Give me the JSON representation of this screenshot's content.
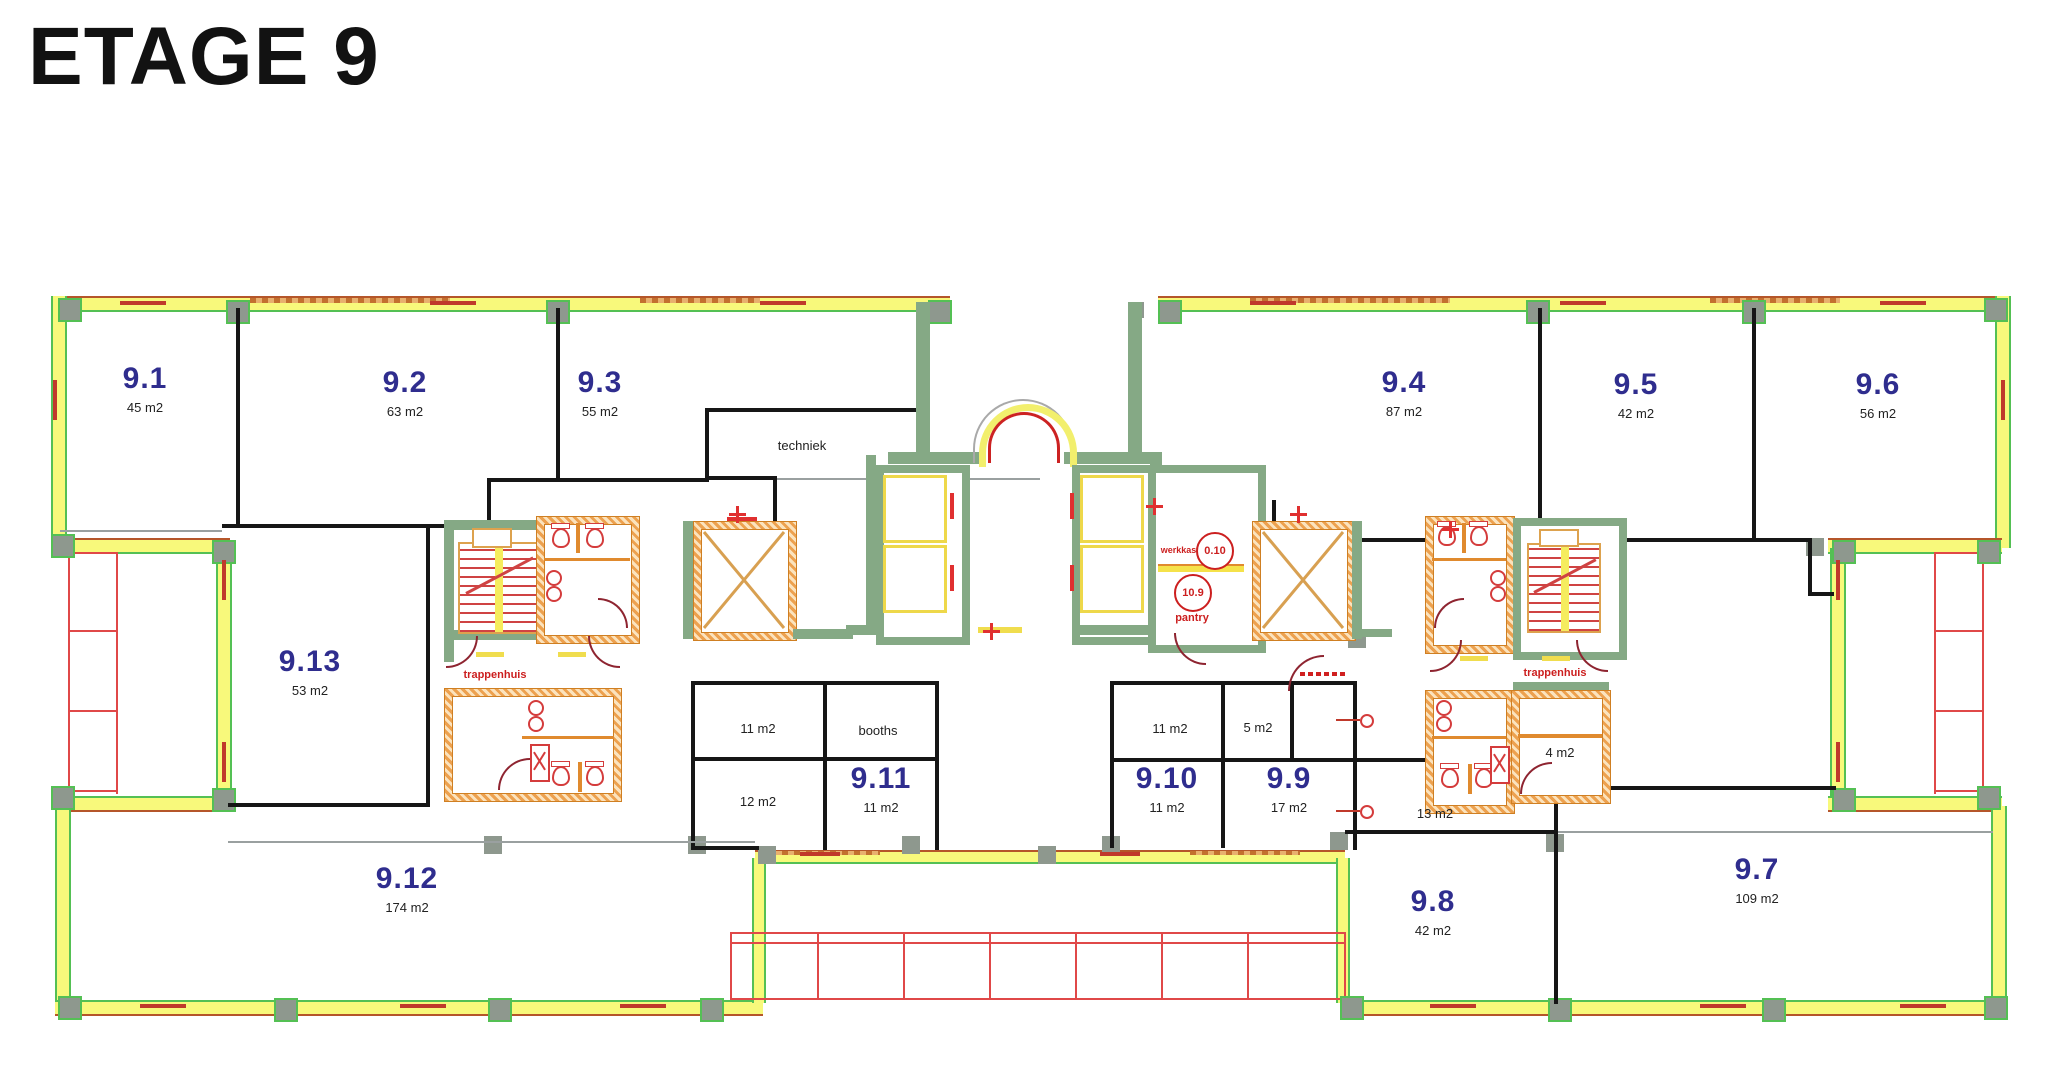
{
  "title": "ETAGE 9",
  "rooms": [
    {
      "number": "9.1",
      "area": "45 m2"
    },
    {
      "number": "9.2",
      "area": "63 m2"
    },
    {
      "number": "9.3",
      "area": "55 m2"
    },
    {
      "number": "9.4",
      "area": "87 m2"
    },
    {
      "number": "9.5",
      "area": "42 m2"
    },
    {
      "number": "9.6",
      "area": "56 m2"
    },
    {
      "number": "9.7",
      "area": "109 m2"
    },
    {
      "number": "9.8",
      "area": "42 m2"
    },
    {
      "number": "9.9",
      "area": "17 m2"
    },
    {
      "number": "9.10",
      "area": "11 m2"
    },
    {
      "number": "9.11",
      "area": "11 m2"
    },
    {
      "number": "9.12",
      "area": "174 m2"
    },
    {
      "number": "9.13",
      "area": "53 m2"
    }
  ],
  "small": {
    "techniek": "techniek",
    "booths": "booths",
    "r11a": "11 m2",
    "r12": "12 m2",
    "r11b": "11 m2",
    "r5": "5 m2",
    "r13": "13 m2",
    "r4": "4 m2"
  },
  "core": {
    "trappenhuis_left": "trappenhuis",
    "trappenhuis_right": "trappenhuis",
    "werkkast": "werkkast",
    "pantry": "pantry",
    "circle_a": "0.10",
    "circle_b": "10.9"
  },
  "colors": {
    "room_number_navy": "#2f2d8e",
    "core_wall_green": "#85a985",
    "exterior_yellow": "#f8f97b",
    "exterior_green": "#54c054",
    "hatch_orange": "#eda14f",
    "fixture_red": "#d43c3c",
    "label_red": "#cc1f1f",
    "column_gray": "#8e988e",
    "wall_black": "#161616"
  }
}
